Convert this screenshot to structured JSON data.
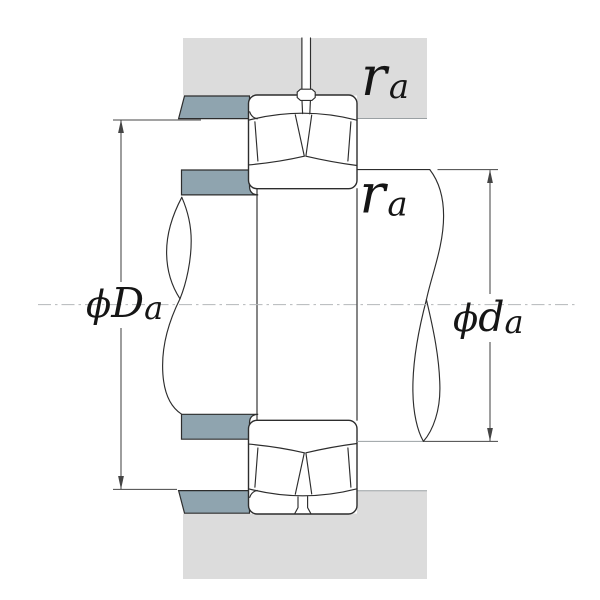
{
  "labels": {
    "housing_fillet": {
      "main": "r",
      "sub": "a"
    },
    "shaft_fillet": {
      "main": "r",
      "sub": "a"
    },
    "housing_abutment_diameter": {
      "phi": "ϕ",
      "main": "D",
      "sub": "a"
    },
    "shaft_abutment_diameter": {
      "phi": "ϕ",
      "main": "d",
      "sub": "a"
    }
  },
  "colors": {
    "bg": "#ffffff",
    "housing-gray": "#dcdcdc",
    "shoulder-blue": "#8fa4af",
    "line-dark": "#2d2d2d",
    "line-light": "#9aa0a3",
    "dim-line": "#454545",
    "centerline": "#b4b7b9",
    "text": "#151515"
  }
}
